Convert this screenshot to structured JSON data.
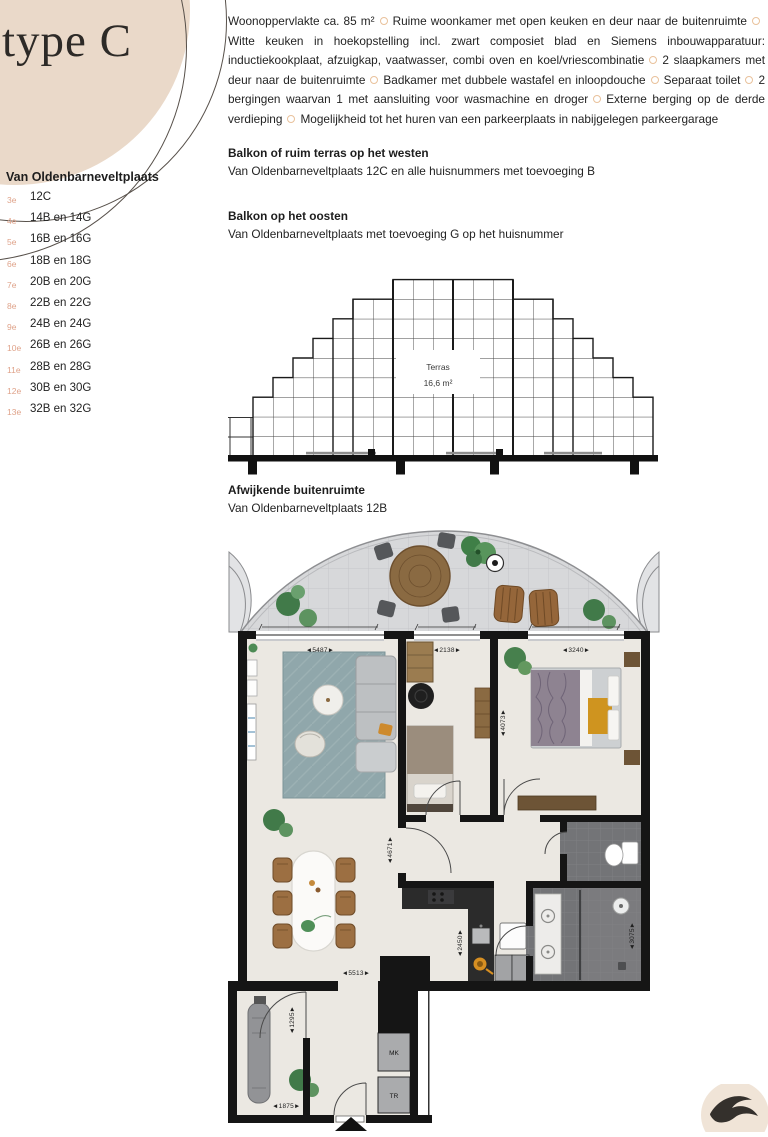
{
  "hero": {
    "type_label": "type C",
    "circle_color": "#ead9c9"
  },
  "address_list": {
    "title": "Van Oldenbarneveltplaats",
    "floor_label_color": "#dfa289",
    "items": [
      {
        "floor": "3e",
        "units": "12C"
      },
      {
        "floor": "4e",
        "units": "14B en 14G"
      },
      {
        "floor": "5e",
        "units": "16B en 16G"
      },
      {
        "floor": "6e",
        "units": "18B en 18G"
      },
      {
        "floor": "7e",
        "units": "20B en 20G"
      },
      {
        "floor": "8e",
        "units": "22B en 22G"
      },
      {
        "floor": "9e",
        "units": "24B en 24G"
      },
      {
        "floor": "10e",
        "units": "26B en 26G"
      },
      {
        "floor": "11e",
        "units": "28B en 28G"
      },
      {
        "floor": "12e",
        "units": "30B en 30G"
      },
      {
        "floor": "13e",
        "units": "32B en 32G"
      }
    ]
  },
  "description": {
    "bullet_color": "#e9c19b",
    "features": [
      "Woonoppervlakte ca. 85 m²",
      "Ruime woonkamer met open keuken en deur naar de buitenruimte",
      "Witte keuken in hoekopstelling incl. zwart composiet blad en Siemens inbouwapparatuur: inductiekookplaat, afzuigkap, vaatwasser, combi oven en koel/vriescombinatie",
      "2 slaapkamers met deur naar de buitenruimte",
      "Badkamer met dubbele wastafel en inloopdouche",
      "Separaat toilet",
      "2 bergingen waarvan 1 met aansluiting voor wasmachine en droger",
      "Externe berging op de derde verdieping",
      "Mogelijkheid tot het huren van een parkeerplaats in nabijgelegen parkeergarage"
    ]
  },
  "sections": {
    "west": {
      "title": "Balkon of ruim terras op het westen",
      "body": "Van Oldenbarneveltplaats 12C en alle huisnummers met toevoeging B"
    },
    "east": {
      "title": "Balkon op het oosten",
      "body": "Van Oldenbarneveltplaats met toevoeging G op het huisnummer"
    },
    "deviating": {
      "title": "Afwijkende buitenruimte",
      "body": "Van Oldenbarneveltplaats 12B"
    }
  },
  "terrace_diagram": {
    "label_line1": "Terras",
    "label_line2": "16,6 m²"
  },
  "floorplan": {
    "dims": {
      "living_window": "◄5487►",
      "bed1_window": "◄2138►",
      "bed2_window": "◄3240►",
      "bed2_depth": "◄4073►",
      "living_depth": "◄4671►",
      "living_bottom": "◄5513►",
      "kitchen": "◄2450►",
      "bathroom": "◄3075►",
      "storage_depth": "◄1295►",
      "storage_width": "◄1875►"
    },
    "closets": {
      "top": "MK",
      "bottom": "TR"
    }
  },
  "colors": {
    "accent_beige": "#ead9c9",
    "floor_label": "#dfa289",
    "bullet_outline": "#e9c19b",
    "terrace_tile": "#d7d8da",
    "floor_cream": "#ebe8e2",
    "wall_black": "#151515",
    "rug_teal": "#90a7ab",
    "bath_tile": "#737477",
    "wood_brown": "#9c6f42"
  }
}
